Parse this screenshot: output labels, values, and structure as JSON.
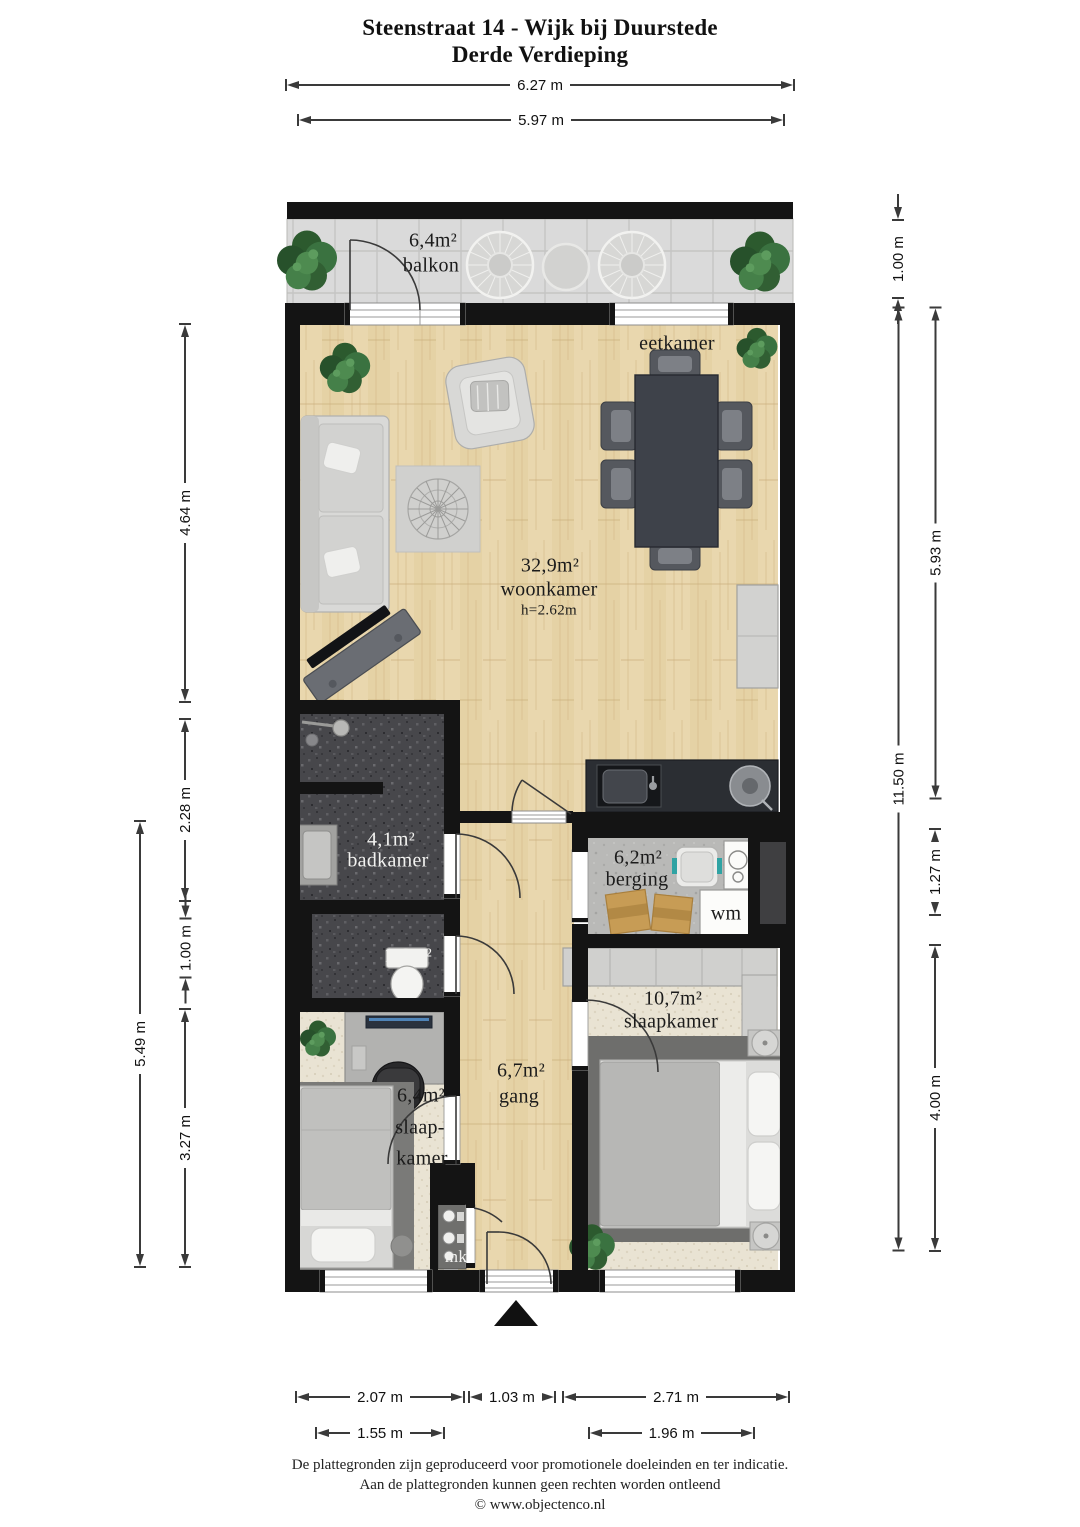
{
  "title": {
    "line1": "Steenstraat 14 - Wijk bij Duurstede",
    "line2": "Derde Verdieping"
  },
  "rooms": {
    "balkon": {
      "area": "6,4m²",
      "name": "balkon"
    },
    "eetkamer": {
      "name": "eetkamer"
    },
    "woonkamer": {
      "area": "32,9m²",
      "name": "woonkamer",
      "ceiling": "h=2.62m"
    },
    "badkamer": {
      "area": "4,1m²",
      "name": "badkamer"
    },
    "toilet": {
      "area": "1,6m²"
    },
    "berging": {
      "area": "6,2m²",
      "name": "berging"
    },
    "wasmachine": {
      "label": "wm"
    },
    "slaapkamer_rechts": {
      "area": "10,7m²",
      "name": "slaapkamer"
    },
    "gang": {
      "area": "6,7m²",
      "name": "gang"
    },
    "slaapkamer_links": {
      "area": "6,4m²",
      "line1": "slaap-",
      "line2": "kamer"
    },
    "meterkast": {
      "label": "mk"
    }
  },
  "dims": {
    "top_total": "6.27 m",
    "top_inner": "5.97 m",
    "left_1": "4.64 m",
    "left_2": "2.28 m",
    "left_3": "1.00 m",
    "left_4": "3.27 m",
    "left_total": "5.49 m",
    "right_balkon": "1.00 m",
    "right_1": "5.93 m",
    "right_2": "1.27 m",
    "right_3": "4.00 m",
    "right_total": "11.50 m",
    "bottom_1": "2.07 m",
    "bottom_2": "1.03 m",
    "bottom_3": "2.71 m",
    "bottom_inner_1": "1.55 m",
    "bottom_inner_2": "1.96 m"
  },
  "footer": {
    "line1": "De plattegronden zijn geproduceerd voor promotionele doeleinden en ter indicatie.",
    "line2": "Aan de plattegronden kunnen geen rechten worden ontleend",
    "line3": "© www.objectenco.nl"
  },
  "colors": {
    "wall": "#141414",
    "wood_floor": "#e9d7ae",
    "balcony_tile": "#dadada",
    "bathroom_tile": "#47474b",
    "carpet": "#e9e3d3",
    "concrete": "#b9b9b7",
    "plant_green": "#2f5e31",
    "basket_accent_teal": "#2fa3a3"
  }
}
